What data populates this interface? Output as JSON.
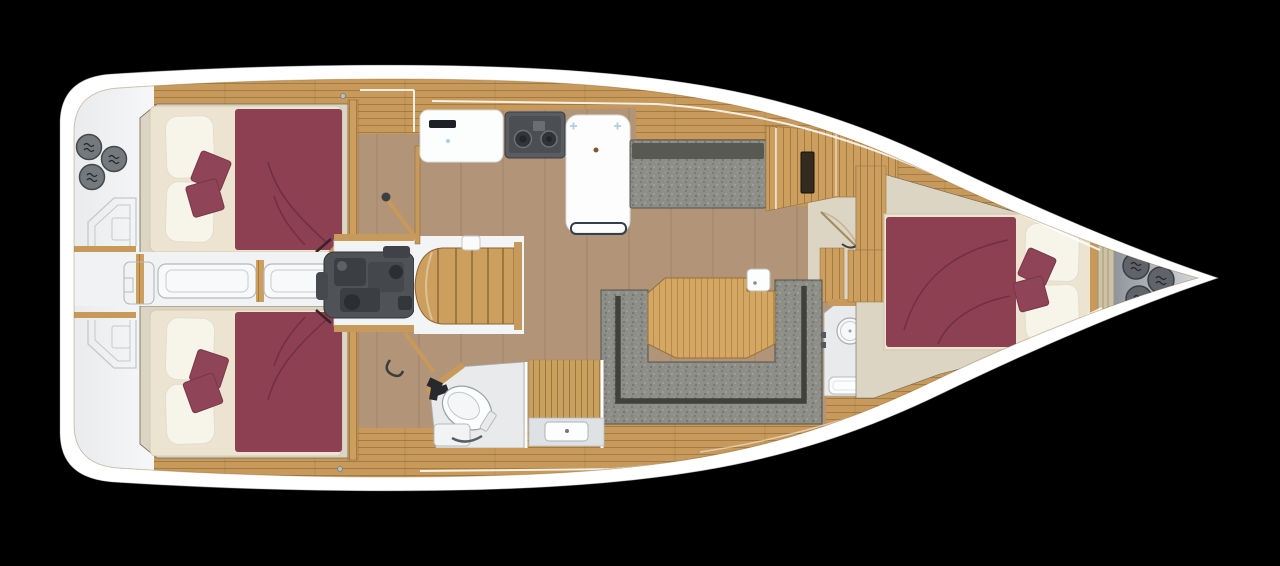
{
  "scene": {
    "description": "Sailing yacht interior floor plan, top-down view, bow pointing right, hull on black background",
    "no_visible_text": true,
    "background": "#000000"
  },
  "palette": {
    "background": "#000000",
    "hull": "#ffffff",
    "sternDeck": "#f3f4f6",
    "passageWhite": "#f1f2f4",
    "oak": "#c7995a",
    "oak2": "#cd9f5e",
    "tableWood": "#d4a763",
    "floor": "#b29478",
    "cabinFloor": "#ddd5c3",
    "mattress": "#ece4d0",
    "pillow": "#f7f4ea",
    "duvet": "#8c4052",
    "cushion": "#8f4458",
    "sofa": "#8e8e88",
    "sofaBack": "#3c3d37",
    "engine": "#4f5357",
    "stove": "#595d61",
    "bathFloor": "#e8eaec",
    "fixture": "#fcfdfe",
    "winch": "#74797d",
    "bowBag": "#60646a",
    "chainLocker": "#ccc2a6",
    "panelDark": "#342a20",
    "accentBlue": "#aecde2"
  },
  "rooms": {
    "stern_deck": {
      "label": "Stern deck and transom lockers",
      "winches": 3
    },
    "aft_cabin_port": {
      "label": "Aft cabin port with double berth",
      "pillows": 2,
      "cushions": 2
    },
    "aft_cabin_starboard": {
      "label": "Aft cabin starboard with double berth",
      "pillows": 2,
      "cushions": 2
    },
    "engine_compartment": {
      "label": "Engine compartment under companionway"
    },
    "companionway": {
      "label": "Companionway steps",
      "steps": 5
    },
    "galley": {
      "label": "Galley with counter, two-burner stove and island unit",
      "burners": 2
    },
    "salon": {
      "label": "Salon with settee, U-shaped sofa and dining table"
    },
    "aft_head": {
      "label": "Aft head with toilet, shower and sink vanity"
    },
    "forward_head": {
      "label": "Forward head with sink, toilet and shower tray"
    },
    "forward_cabin": {
      "label": "Forward cabin with double berth",
      "pillows": 2,
      "cushions": 2
    },
    "bow_locker": {
      "label": "Bow locker",
      "storage_drums": 3
    }
  }
}
